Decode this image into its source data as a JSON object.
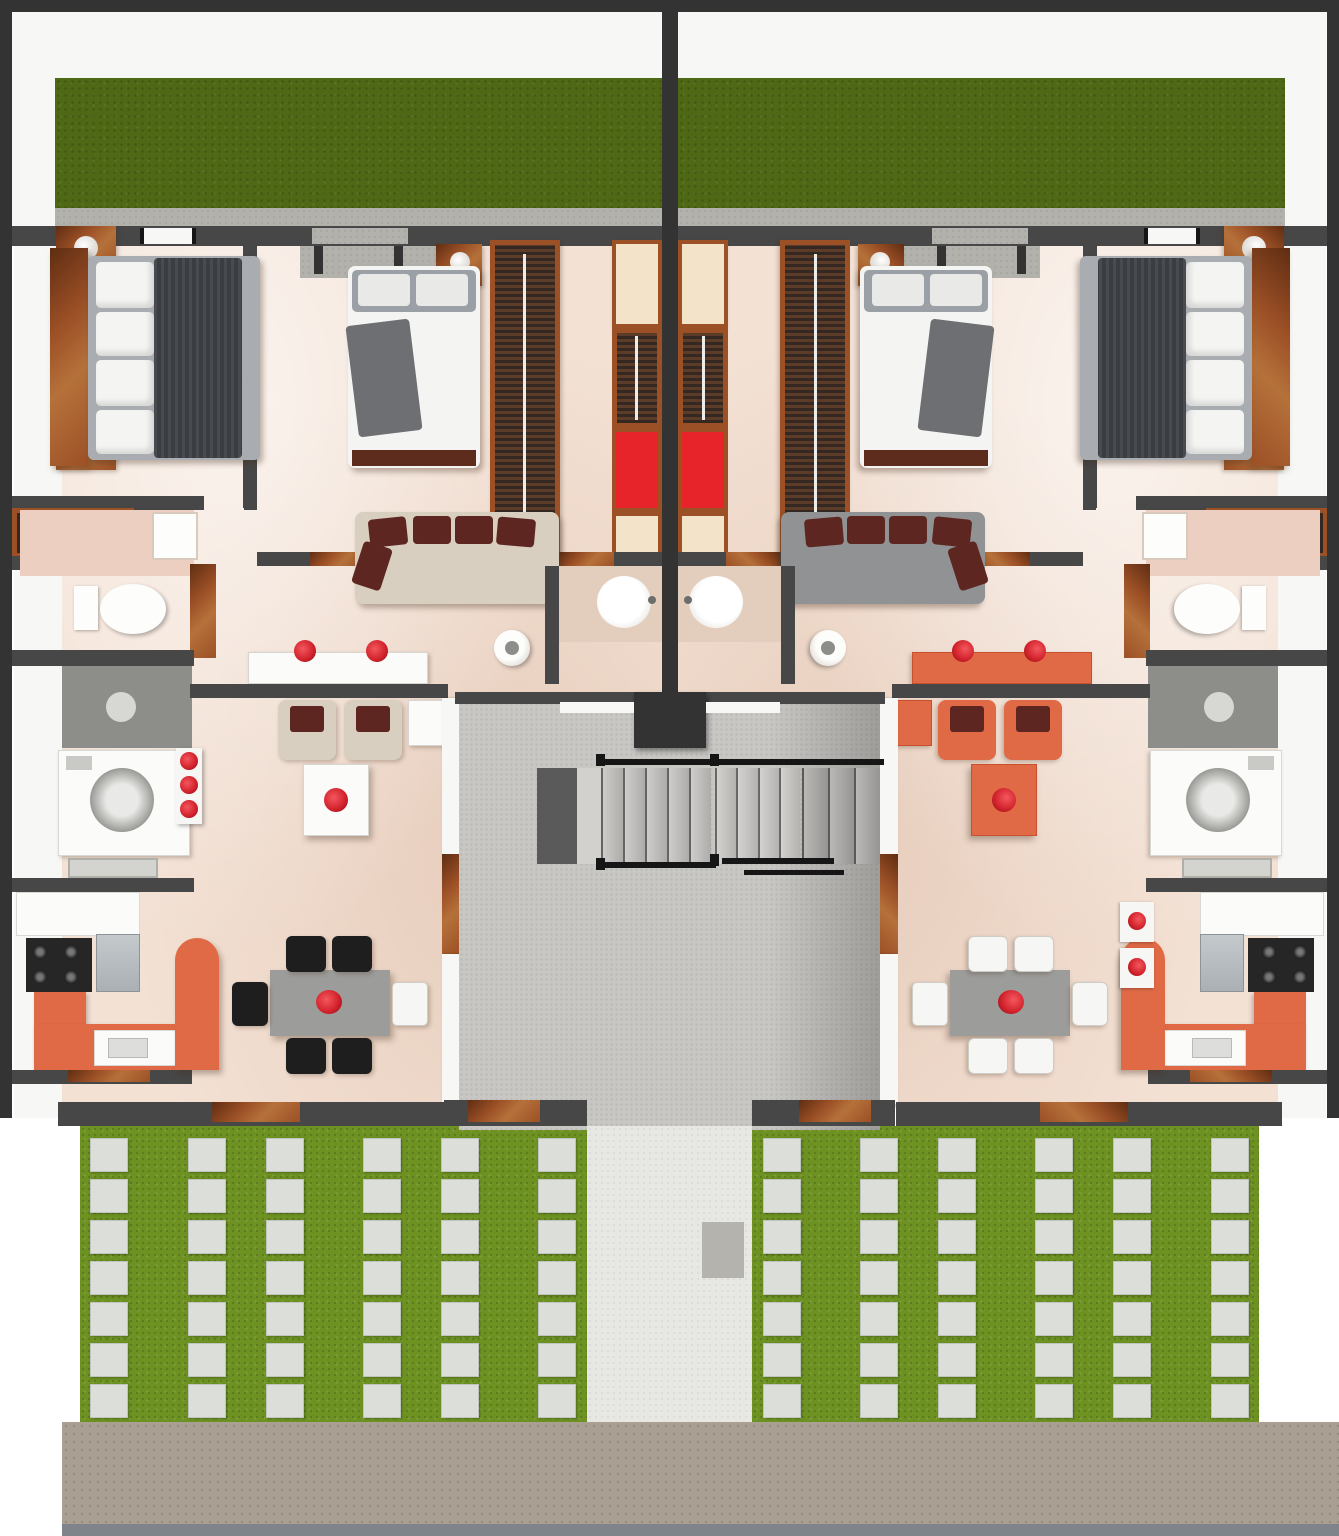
{
  "scene": {
    "kind": "3d-floor-plan-top-view",
    "subject": "duplex-apartment-ground-floor",
    "units_count": 2,
    "mirrored_layout": true
  },
  "palette": {
    "wall": "#474747",
    "wall_dark": "#333333",
    "wall_light": "#f7f7f5",
    "backyard_grass": "#4e6815",
    "front_grass": "#6d9222",
    "paver": "#dcdeda",
    "concrete": "#b2b1ab",
    "stair_floor": "#c8c7c4",
    "stair_floor_dark": "#a3a19e",
    "stair_landing_dark": "#5a5a5a",
    "path": "#e7e7e4",
    "doormat": "#b5b3ae",
    "sidewalk": "#a9a093",
    "curb": "#7f848b",
    "marble": "#f3e1d4",
    "wood": "#9c5026",
    "wood_dark": "#5f2d12",
    "clothes": "#352823",
    "rail": "#ececea",
    "closet_cream": "#f3e3c8",
    "closet_red": "#e8242b",
    "mattress": "#a9adb2",
    "blanket_dark": "#3a3d42",
    "blanket_navy": "#2b3e52",
    "bed_white": "#f4f4f2",
    "pillow_gray": "#9aa0a5",
    "bed_brown": "#5d2c1d",
    "sofa_beige": "#d9cfc0",
    "cushion_maroon": "#5e2621",
    "sofa_gray": "#909293",
    "accent_orange": "#e16a46",
    "accent_orange_dark": "#c9502f",
    "table_gray": "#9c9c9a",
    "table_gray_dark": "#7c7c7a",
    "table_white": "#fbfbf9",
    "chair_black": "#1e1e1e",
    "chair_white": "#f6f6f4",
    "appliance": "#fbfbfa",
    "steel": "#aab0b4",
    "counter_gray": "#8d8d89",
    "counter_tan": "#e3cdbc",
    "red": "#d0202a",
    "toilet": "#fdfdfc",
    "tile": "#eccfc0"
  },
  "units": {
    "left": {
      "rooms": [
        "master-bedroom",
        "bedroom-2",
        "walk-in-closet",
        "bathroom",
        "laundry",
        "living-room",
        "kitchen",
        "dining-room",
        "hall"
      ],
      "dining_chairs": "chair_black",
      "sofa": "sofa_beige",
      "lounge_accent": "sofa_beige",
      "master_bed_blanket": "blanket_dark",
      "tables": "table_white"
    },
    "right": {
      "rooms": [
        "master-bedroom",
        "bedroom-2",
        "walk-in-closet",
        "bathroom",
        "laundry",
        "living-room",
        "kitchen",
        "dining-room",
        "hall"
      ],
      "dining_chairs": "chair_white",
      "sofa": "sofa_gray",
      "lounge_accent": "accent_orange",
      "master_bed_blanket": "blanket_navy",
      "tables": "accent_orange"
    }
  },
  "backyard": {
    "grass_strips": 2
  },
  "front_yard": {
    "paver_columns": 6,
    "paver_rows": 7,
    "paver_w": 38,
    "paver_h": 34,
    "row_pitch": 41,
    "row_start_offset": 4,
    "column_offsets": [
      10,
      108,
      186,
      283,
      361,
      458
    ],
    "left_area": {
      "x": 80,
      "y": 1134,
      "w": 507,
      "h": 288,
      "mirrored": false
    },
    "right_area": {
      "x": 752,
      "y": 1134,
      "w": 507,
      "h": 288,
      "mirrored": true
    }
  },
  "stairs": {
    "flight1_treads": 5,
    "flight2_treads": 4,
    "flight3_treads": 3,
    "has_dark_landing": true
  }
}
